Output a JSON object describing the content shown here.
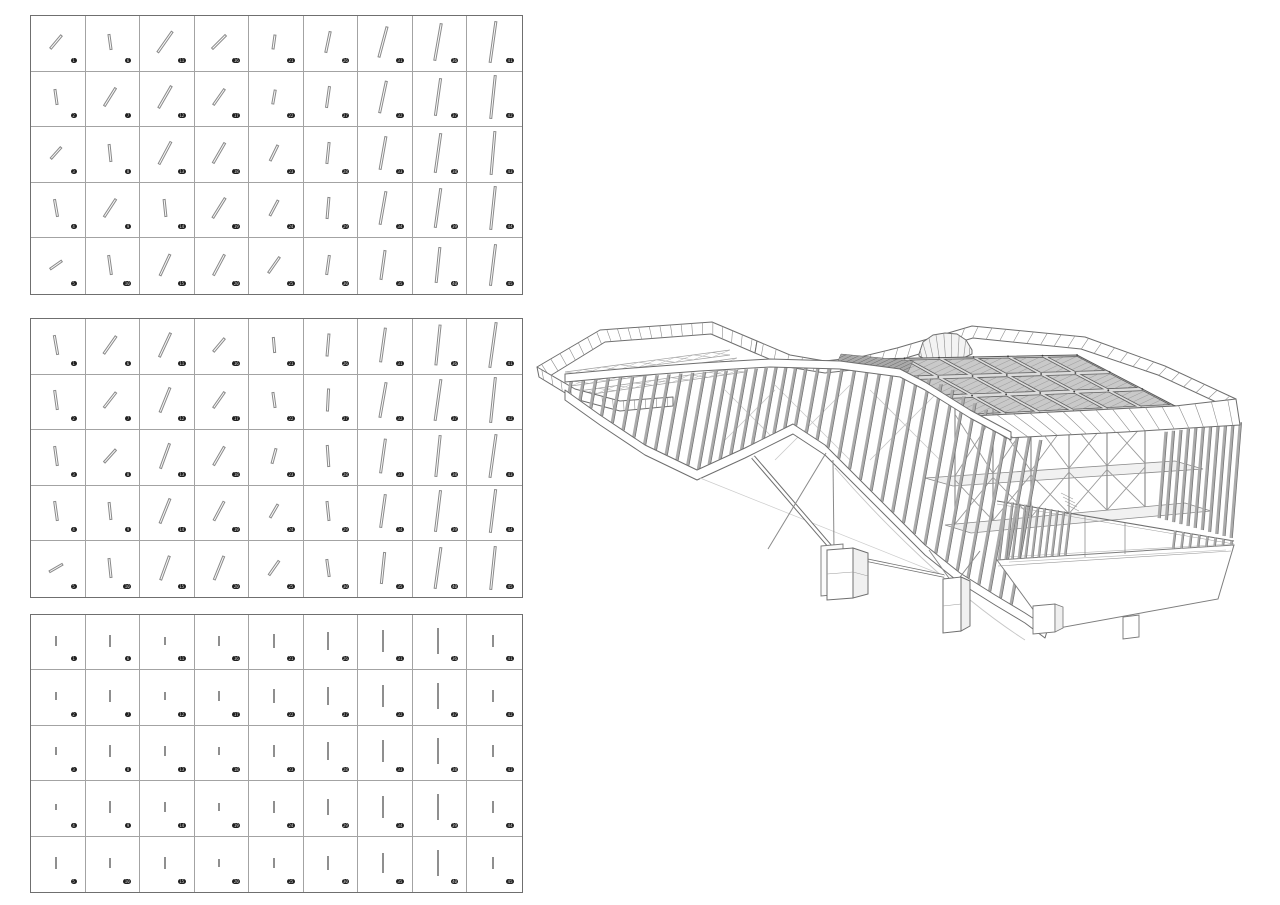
{
  "page": {
    "description": "Facade slat rotation study grids with wireframe pavilion axonometric",
    "background": "#ffffff",
    "badge_bg": "#1f1f1f",
    "badge_fg": "#d6d6d6"
  },
  "grids": [
    {
      "name": "rotation-study-grid-1",
      "x": 30,
      "y": 15,
      "w": 493,
      "h": 280,
      "cols": 9,
      "rows": 5,
      "stick_style": "outlined",
      "cells": [
        [
          40,
          18,
          "1"
        ],
        [
          -8,
          16,
          "6"
        ],
        [
          35,
          26,
          "11"
        ],
        [
          45,
          20,
          "16"
        ],
        [
          8,
          15,
          "21"
        ],
        [
          12,
          22,
          "26"
        ],
        [
          15,
          32,
          "31"
        ],
        [
          10,
          38,
          "36"
        ],
        [
          8,
          42,
          "41"
        ],
        [
          -8,
          16,
          "2"
        ],
        [
          32,
          22,
          "7"
        ],
        [
          30,
          26,
          "12"
        ],
        [
          35,
          20,
          "17"
        ],
        [
          10,
          15,
          "22"
        ],
        [
          8,
          22,
          "27"
        ],
        [
          12,
          33,
          "32"
        ],
        [
          8,
          38,
          "37"
        ],
        [
          6,
          44,
          "42"
        ],
        [
          42,
          16,
          "3"
        ],
        [
          -6,
          18,
          "8"
        ],
        [
          28,
          26,
          "13"
        ],
        [
          30,
          24,
          "18"
        ],
        [
          26,
          18,
          "23"
        ],
        [
          6,
          22,
          "28"
        ],
        [
          10,
          34,
          "33"
        ],
        [
          8,
          40,
          "38"
        ],
        [
          5,
          44,
          "43"
        ],
        [
          -10,
          18,
          "4"
        ],
        [
          33,
          22,
          "9"
        ],
        [
          -6,
          18,
          "14"
        ],
        [
          32,
          24,
          "19"
        ],
        [
          28,
          18,
          "24"
        ],
        [
          5,
          22,
          "29"
        ],
        [
          10,
          34,
          "34"
        ],
        [
          8,
          40,
          "39"
        ],
        [
          6,
          44,
          "44"
        ],
        [
          55,
          15,
          "5"
        ],
        [
          -8,
          20,
          "10"
        ],
        [
          25,
          24,
          "15"
        ],
        [
          28,
          24,
          "20"
        ],
        [
          35,
          20,
          "25"
        ],
        [
          8,
          20,
          "30"
        ],
        [
          8,
          30,
          "35"
        ],
        [
          6,
          36,
          "40"
        ],
        [
          7,
          42,
          "45"
        ]
      ]
    },
    {
      "name": "rotation-study-grid-2",
      "x": 30,
      "y": 318,
      "w": 493,
      "h": 280,
      "cols": 9,
      "rows": 5,
      "stick_style": "outlined",
      "cells": [
        [
          -10,
          20,
          "1"
        ],
        [
          35,
          22,
          "6"
        ],
        [
          25,
          27,
          "11"
        ],
        [
          40,
          18,
          "16"
        ],
        [
          -5,
          16,
          "21"
        ],
        [
          5,
          23,
          "26"
        ],
        [
          8,
          35,
          "31"
        ],
        [
          6,
          41,
          "36"
        ],
        [
          8,
          46,
          "41"
        ],
        [
          -8,
          20,
          "2"
        ],
        [
          38,
          20,
          "7"
        ],
        [
          22,
          27,
          "12"
        ],
        [
          35,
          20,
          "17"
        ],
        [
          -8,
          16,
          "22"
        ],
        [
          3,
          23,
          "27"
        ],
        [
          10,
          36,
          "32"
        ],
        [
          8,
          42,
          "37"
        ],
        [
          6,
          46,
          "42"
        ],
        [
          -8,
          20,
          "3"
        ],
        [
          42,
          18,
          "8"
        ],
        [
          20,
          27,
          "13"
        ],
        [
          30,
          22,
          "18"
        ],
        [
          15,
          16,
          "23"
        ],
        [
          -4,
          22,
          "28"
        ],
        [
          8,
          35,
          "33"
        ],
        [
          6,
          42,
          "38"
        ],
        [
          8,
          44,
          "43"
        ],
        [
          -8,
          20,
          "4"
        ],
        [
          -6,
          18,
          "9"
        ],
        [
          22,
          27,
          "14"
        ],
        [
          28,
          22,
          "19"
        ],
        [
          30,
          16,
          "24"
        ],
        [
          -6,
          20,
          "29"
        ],
        [
          8,
          34,
          "34"
        ],
        [
          7,
          42,
          "39"
        ],
        [
          7,
          44,
          "44"
        ],
        [
          60,
          16,
          "5"
        ],
        [
          -6,
          20,
          "10"
        ],
        [
          20,
          26,
          "15"
        ],
        [
          22,
          26,
          "20"
        ],
        [
          35,
          18,
          "25"
        ],
        [
          -8,
          18,
          "30"
        ],
        [
          6,
          32,
          "35"
        ],
        [
          8,
          42,
          "40"
        ],
        [
          6,
          44,
          "45"
        ]
      ]
    },
    {
      "name": "rotation-study-grid-3",
      "x": 30,
      "y": 614,
      "w": 493,
      "h": 279,
      "cols": 9,
      "rows": 5,
      "stick_style": "solid",
      "cells": [
        [
          0,
          10,
          "1"
        ],
        [
          0,
          12,
          "6"
        ],
        [
          0,
          8,
          "11"
        ],
        [
          0,
          10,
          "16"
        ],
        [
          0,
          14,
          "21"
        ],
        [
          0,
          18,
          "26"
        ],
        [
          0,
          22,
          "31"
        ],
        [
          0,
          26,
          "36"
        ],
        [
          0,
          12,
          "41"
        ],
        [
          0,
          8,
          "2"
        ],
        [
          0,
          12,
          "7"
        ],
        [
          0,
          8,
          "12"
        ],
        [
          0,
          10,
          "17"
        ],
        [
          0,
          14,
          "22"
        ],
        [
          0,
          18,
          "27"
        ],
        [
          0,
          22,
          "32"
        ],
        [
          0,
          26,
          "37"
        ],
        [
          0,
          12,
          "42"
        ],
        [
          0,
          8,
          "3"
        ],
        [
          0,
          12,
          "8"
        ],
        [
          0,
          10,
          "13"
        ],
        [
          0,
          8,
          "18"
        ],
        [
          0,
          12,
          "23"
        ],
        [
          0,
          18,
          "28"
        ],
        [
          0,
          22,
          "33"
        ],
        [
          0,
          26,
          "38"
        ],
        [
          0,
          12,
          "43"
        ],
        [
          0,
          6,
          "4"
        ],
        [
          0,
          12,
          "9"
        ],
        [
          0,
          10,
          "14"
        ],
        [
          0,
          8,
          "19"
        ],
        [
          0,
          12,
          "24"
        ],
        [
          0,
          16,
          "29"
        ],
        [
          0,
          22,
          "34"
        ],
        [
          0,
          26,
          "39"
        ],
        [
          0,
          12,
          "44"
        ],
        [
          0,
          12,
          "5"
        ],
        [
          0,
          10,
          "10"
        ],
        [
          0,
          12,
          "15"
        ],
        [
          0,
          8,
          "20"
        ],
        [
          0,
          10,
          "25"
        ],
        [
          0,
          14,
          "30"
        ],
        [
          0,
          20,
          "35"
        ],
        [
          0,
          26,
          "40"
        ],
        [
          0,
          12,
          "45"
        ]
      ]
    }
  ],
  "building": {
    "x": 525,
    "y": 310,
    "w": 740,
    "h": 345,
    "colors": {
      "line": "#6e6e6e",
      "fin": "#ababab",
      "fin_edge": "#6f6f6f",
      "panel": "#c9c9c9",
      "panel_edge": "#5f5f5f",
      "mullion": "#8d8d8d"
    },
    "fins_main": {
      "count": 42,
      "x0": 44,
      "x1": 486,
      "lean": 0.18,
      "width": 3.2,
      "top": [
        [
          40,
          72
        ],
        [
          95,
          67
        ],
        [
          175,
          61
        ],
        [
          245,
          57
        ],
        [
          315,
          59
        ],
        [
          375,
          67
        ],
        [
          400,
          80
        ],
        [
          445,
          108
        ],
        [
          486,
          130
        ]
      ],
      "bottom": [
        [
          40,
          80
        ],
        [
          75,
          105
        ],
        [
          120,
          135
        ],
        [
          172,
          160
        ],
        [
          220,
          138
        ],
        [
          268,
          114
        ],
        [
          300,
          135
        ],
        [
          330,
          165
        ],
        [
          365,
          200
        ],
        [
          400,
          235
        ],
        [
          435,
          263
        ],
        [
          470,
          285
        ],
        [
          500,
          303
        ],
        [
          523,
          318
        ]
      ]
    },
    "fins_right": {
      "count": 11,
      "x0": 634,
      "x1": 706,
      "lean": 0.08,
      "width": 3,
      "top": [
        [
          632,
          122
        ],
        [
          708,
          112
        ]
      ],
      "bottom": [
        [
          630,
          207
        ],
        [
          706,
          228
        ]
      ]
    },
    "bands": [
      {
        "g": "band-terrace-back",
        "upper": [
          [
            12,
            57
          ],
          [
            75,
            20
          ],
          [
            187,
            12
          ],
          [
            232,
            31
          ]
        ],
        "lower": [
          [
            20,
            69
          ],
          [
            80,
            32
          ],
          [
            186,
            24
          ],
          [
            230,
            43
          ]
        ],
        "mullions": 22
      },
      {
        "g": "band-terrace-front",
        "upper": [
          [
            12,
            57
          ],
          [
            50,
            79
          ],
          [
            95,
            91
          ],
          [
            148,
            87
          ]
        ],
        "lower": [
          [
            14,
            67
          ],
          [
            50,
            89
          ],
          [
            95,
            101
          ],
          [
            148,
            96
          ]
        ],
        "mullions": 13
      },
      {
        "g": "band-top-parapet",
        "upper": [
          [
            232,
            31
          ],
          [
            265,
            45
          ],
          [
            300,
            51
          ],
          [
            335,
            47
          ],
          [
            372,
            38
          ],
          [
            447,
            16
          ],
          [
            560,
            27
          ],
          [
            640,
            56
          ],
          [
            711,
            89
          ]
        ],
        "lower": [
          [
            230,
            43
          ],
          [
            263,
            57
          ],
          [
            300,
            63
          ],
          [
            336,
            59
          ],
          [
            374,
            50
          ],
          [
            448,
            28
          ],
          [
            556,
            39
          ],
          [
            633,
            65
          ],
          [
            702,
            97
          ]
        ],
        "mullions": 36
      },
      {
        "g": "band-drum",
        "fill": "#f3f3f3",
        "upper": [
          [
            394,
            44
          ],
          [
            398,
            32
          ],
          [
            408,
            25
          ],
          [
            420,
            23
          ],
          [
            432,
            24
          ],
          [
            441,
            30
          ],
          [
            447,
            40
          ]
        ],
        "lower": [
          [
            394,
            46
          ],
          [
            400,
            49
          ],
          [
            420,
            51
          ],
          [
            436,
            49
          ],
          [
            447,
            44
          ]
        ],
        "mullions": 9
      },
      {
        "g": "band-f2",
        "upper": [
          [
            447,
            106
          ],
          [
            650,
            96
          ],
          [
            711,
            89
          ]
        ],
        "lower": [
          [
            481,
            128
          ],
          [
            600,
            122
          ],
          [
            715,
            115
          ]
        ],
        "mullions": 16
      },
      {
        "g": "band-wave",
        "upper": [
          [
            40,
            64
          ],
          [
            95,
            59
          ],
          [
            175,
            53
          ],
          [
            245,
            49
          ],
          [
            315,
            51
          ],
          [
            375,
            59
          ],
          [
            400,
            72
          ],
          [
            445,
            100
          ],
          [
            486,
            122
          ]
        ],
        "lower": [
          [
            40,
            72
          ],
          [
            95,
            67
          ],
          [
            175,
            61
          ],
          [
            245,
            57
          ],
          [
            315,
            59
          ],
          [
            375,
            67
          ],
          [
            400,
            80
          ],
          [
            445,
            108
          ],
          [
            486,
            130
          ]
        ],
        "mullions": 0
      },
      {
        "g": "band-ribbon",
        "upper": [
          [
            40,
            80
          ],
          [
            75,
            105
          ],
          [
            120,
            135
          ],
          [
            172,
            160
          ],
          [
            220,
            138
          ],
          [
            268,
            114
          ],
          [
            300,
            135
          ],
          [
            330,
            165
          ],
          [
            365,
            200
          ],
          [
            400,
            235
          ],
          [
            435,
            263
          ],
          [
            470,
            285
          ],
          [
            500,
            303
          ],
          [
            523,
            318
          ]
        ],
        "lower": [
          [
            40,
            90
          ],
          [
            75,
            115
          ],
          [
            120,
            145
          ],
          [
            172,
            170
          ],
          [
            220,
            148
          ],
          [
            268,
            124
          ],
          [
            300,
            145
          ],
          [
            330,
            175
          ],
          [
            365,
            210
          ],
          [
            400,
            245
          ],
          [
            435,
            273
          ],
          [
            470,
            295
          ],
          [
            500,
            313
          ],
          [
            520,
            328
          ]
        ],
        "mullions": 0
      }
    ],
    "skylight": {
      "corners": [
        [
          345,
          49
        ],
        [
          552,
          45
        ],
        [
          650,
          96
        ],
        [
          447,
          106
        ]
      ],
      "rows": 3,
      "cols": 6
    },
    "trusses": [
      {
        "a": [
          40,
          62
        ],
        "b": [
          205,
          40
        ]
      },
      {
        "a": [
          46,
          71
        ],
        "b": [
          212,
          48
        ]
      },
      {
        "a": [
          54,
          81
        ],
        "b": [
          220,
          57
        ]
      }
    ],
    "interior": {
      "posts": [
        430,
        468,
        506,
        544,
        582,
        620
      ],
      "roof": [
        [
          400,
          95
        ],
        [
          650,
          106
        ]
      ],
      "floor1": [
        [
          400,
          168
        ],
        [
          650,
          151
        ]
      ],
      "floor2": [
        [
          420,
          215
        ],
        [
          660,
          193
        ]
      ]
    },
    "railing": {
      "top": [
        [
          472,
          191
        ],
        [
          709,
          231
        ]
      ],
      "bottom": [
        [
          472,
          250
        ],
        [
          709,
          235
        ]
      ],
      "width": 2.4,
      "clusters": [
        {
          "x0": 474,
          "x1": 540,
          "n": 11
        },
        {
          "x0": 648,
          "x1": 706,
          "n": 8
        }
      ]
    }
  }
}
